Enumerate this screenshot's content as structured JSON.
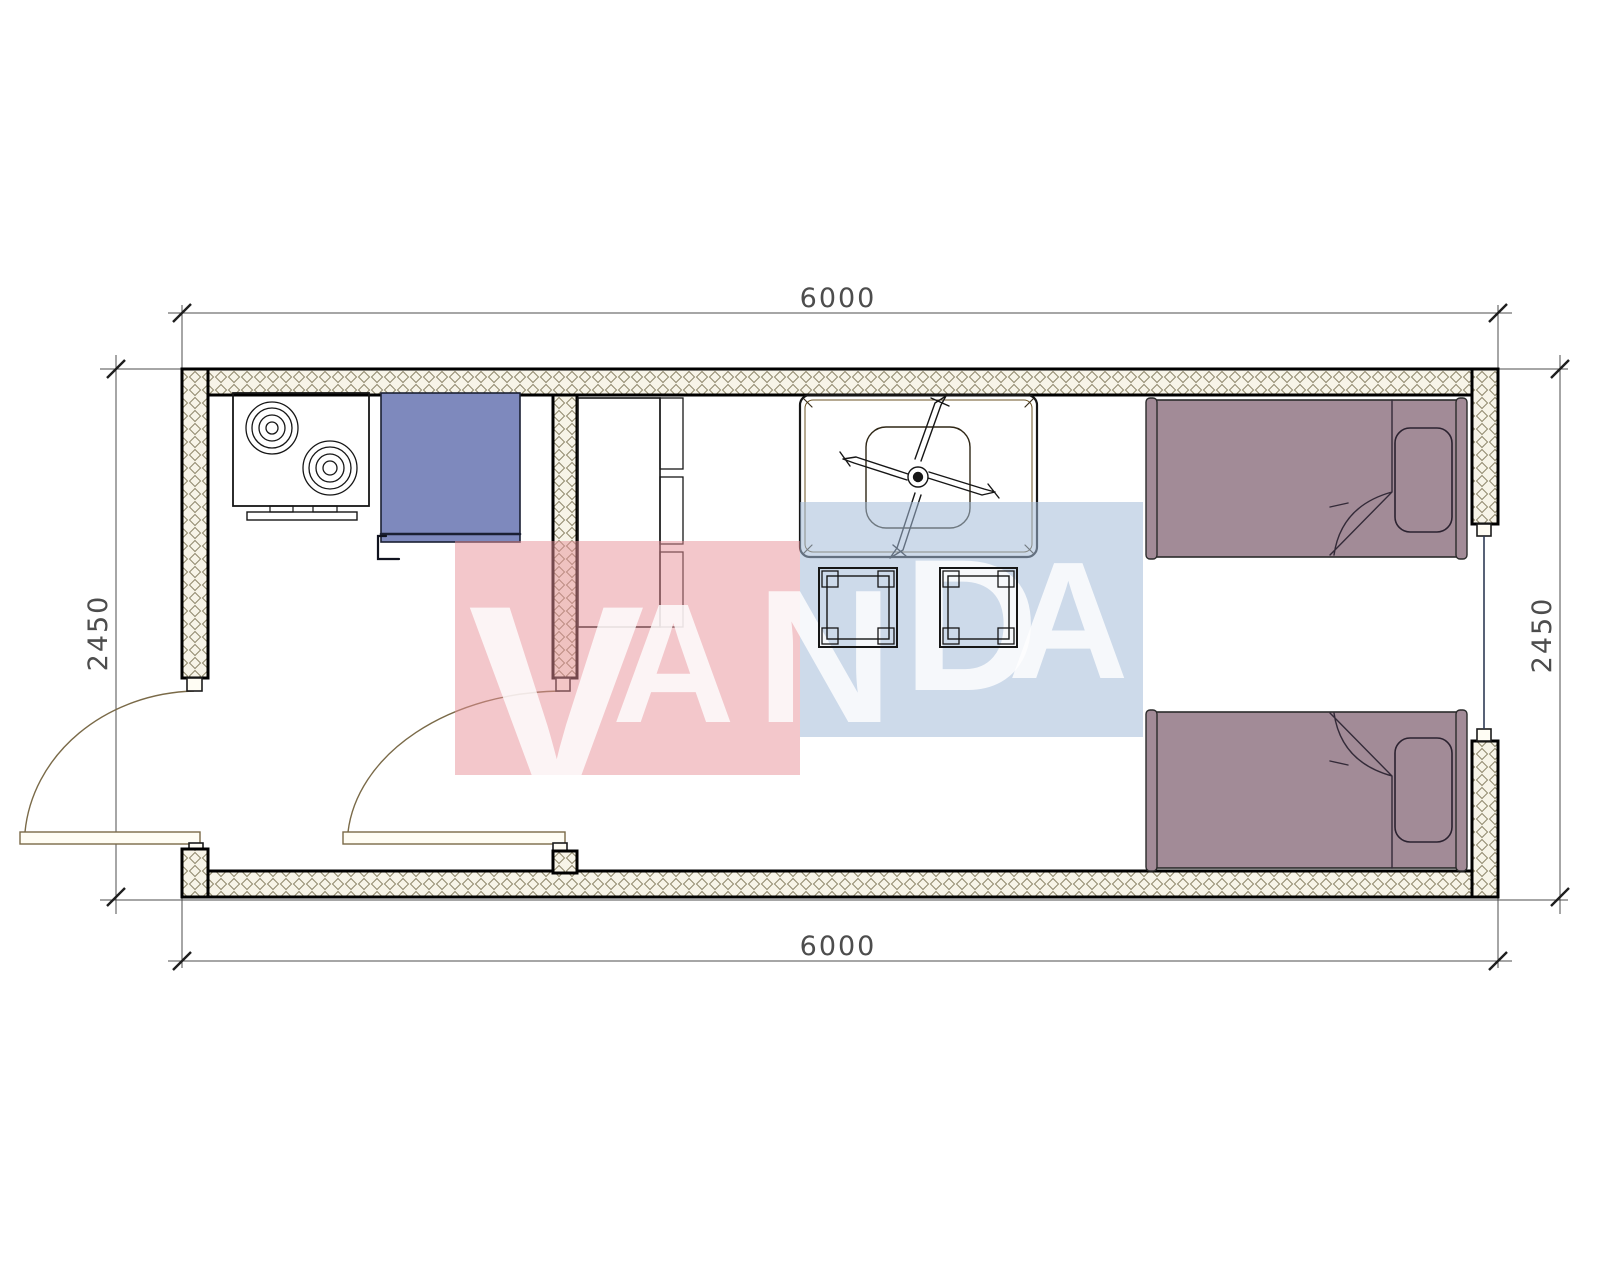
{
  "document": {
    "type_label": "container-house-floor-plan",
    "background": "#ffffff"
  },
  "dimensions": {
    "top": "6000",
    "bottom": "6000",
    "left": "2450",
    "right": "2450"
  },
  "watermark": {
    "word": "VANDA",
    "letters": [
      {
        "ch": "V"
      },
      {
        "ch": "A"
      },
      {
        "ch": "N"
      },
      {
        "ch": "D"
      },
      {
        "ch": "A"
      }
    ],
    "pink_block": "#e88f98",
    "blue_block": "#a4bcd8",
    "letter_color": "#ffffff"
  },
  "palette": {
    "wall-hatch-bg": "#f7f4e8",
    "wall-hatch-line": "#8f886c",
    "wall-stroke": "#000000",
    "stove-fill": "#a5a77a",
    "appliance-fill": "#7e89bd",
    "appliance-edge": "#1b2033",
    "cabinet-fill": "#6e3120",
    "cabinet-band": "#7d3d2b",
    "table-fill": "#cf9a41",
    "stool-fill": "#8494a5",
    "stool-leg": "#9fadbb",
    "stool-inner": "#76899d",
    "bed-fill": "#a28b97",
    "bed-line": "#2b2b2b",
    "door-line": "#7a6a48",
    "dim-color": "#4d4d4d",
    "window-line": "#2e3b55"
  },
  "inventory": {
    "rooms": [
      "kitchen",
      "living-bedroom"
    ],
    "items": [
      {
        "name": "cooktop-stove",
        "burners": 2
      },
      {
        "name": "blue-appliance",
        "count": 1
      },
      {
        "name": "wardrobe-cabinet",
        "drawers": 3
      },
      {
        "name": "dining-table",
        "count": 1
      },
      {
        "name": "ceiling-fan",
        "blades": 4
      },
      {
        "name": "stool",
        "count": 2
      },
      {
        "name": "single-bed",
        "count": 2
      },
      {
        "name": "swing-door",
        "count": 2
      },
      {
        "name": "window",
        "count": 1
      }
    ]
  }
}
